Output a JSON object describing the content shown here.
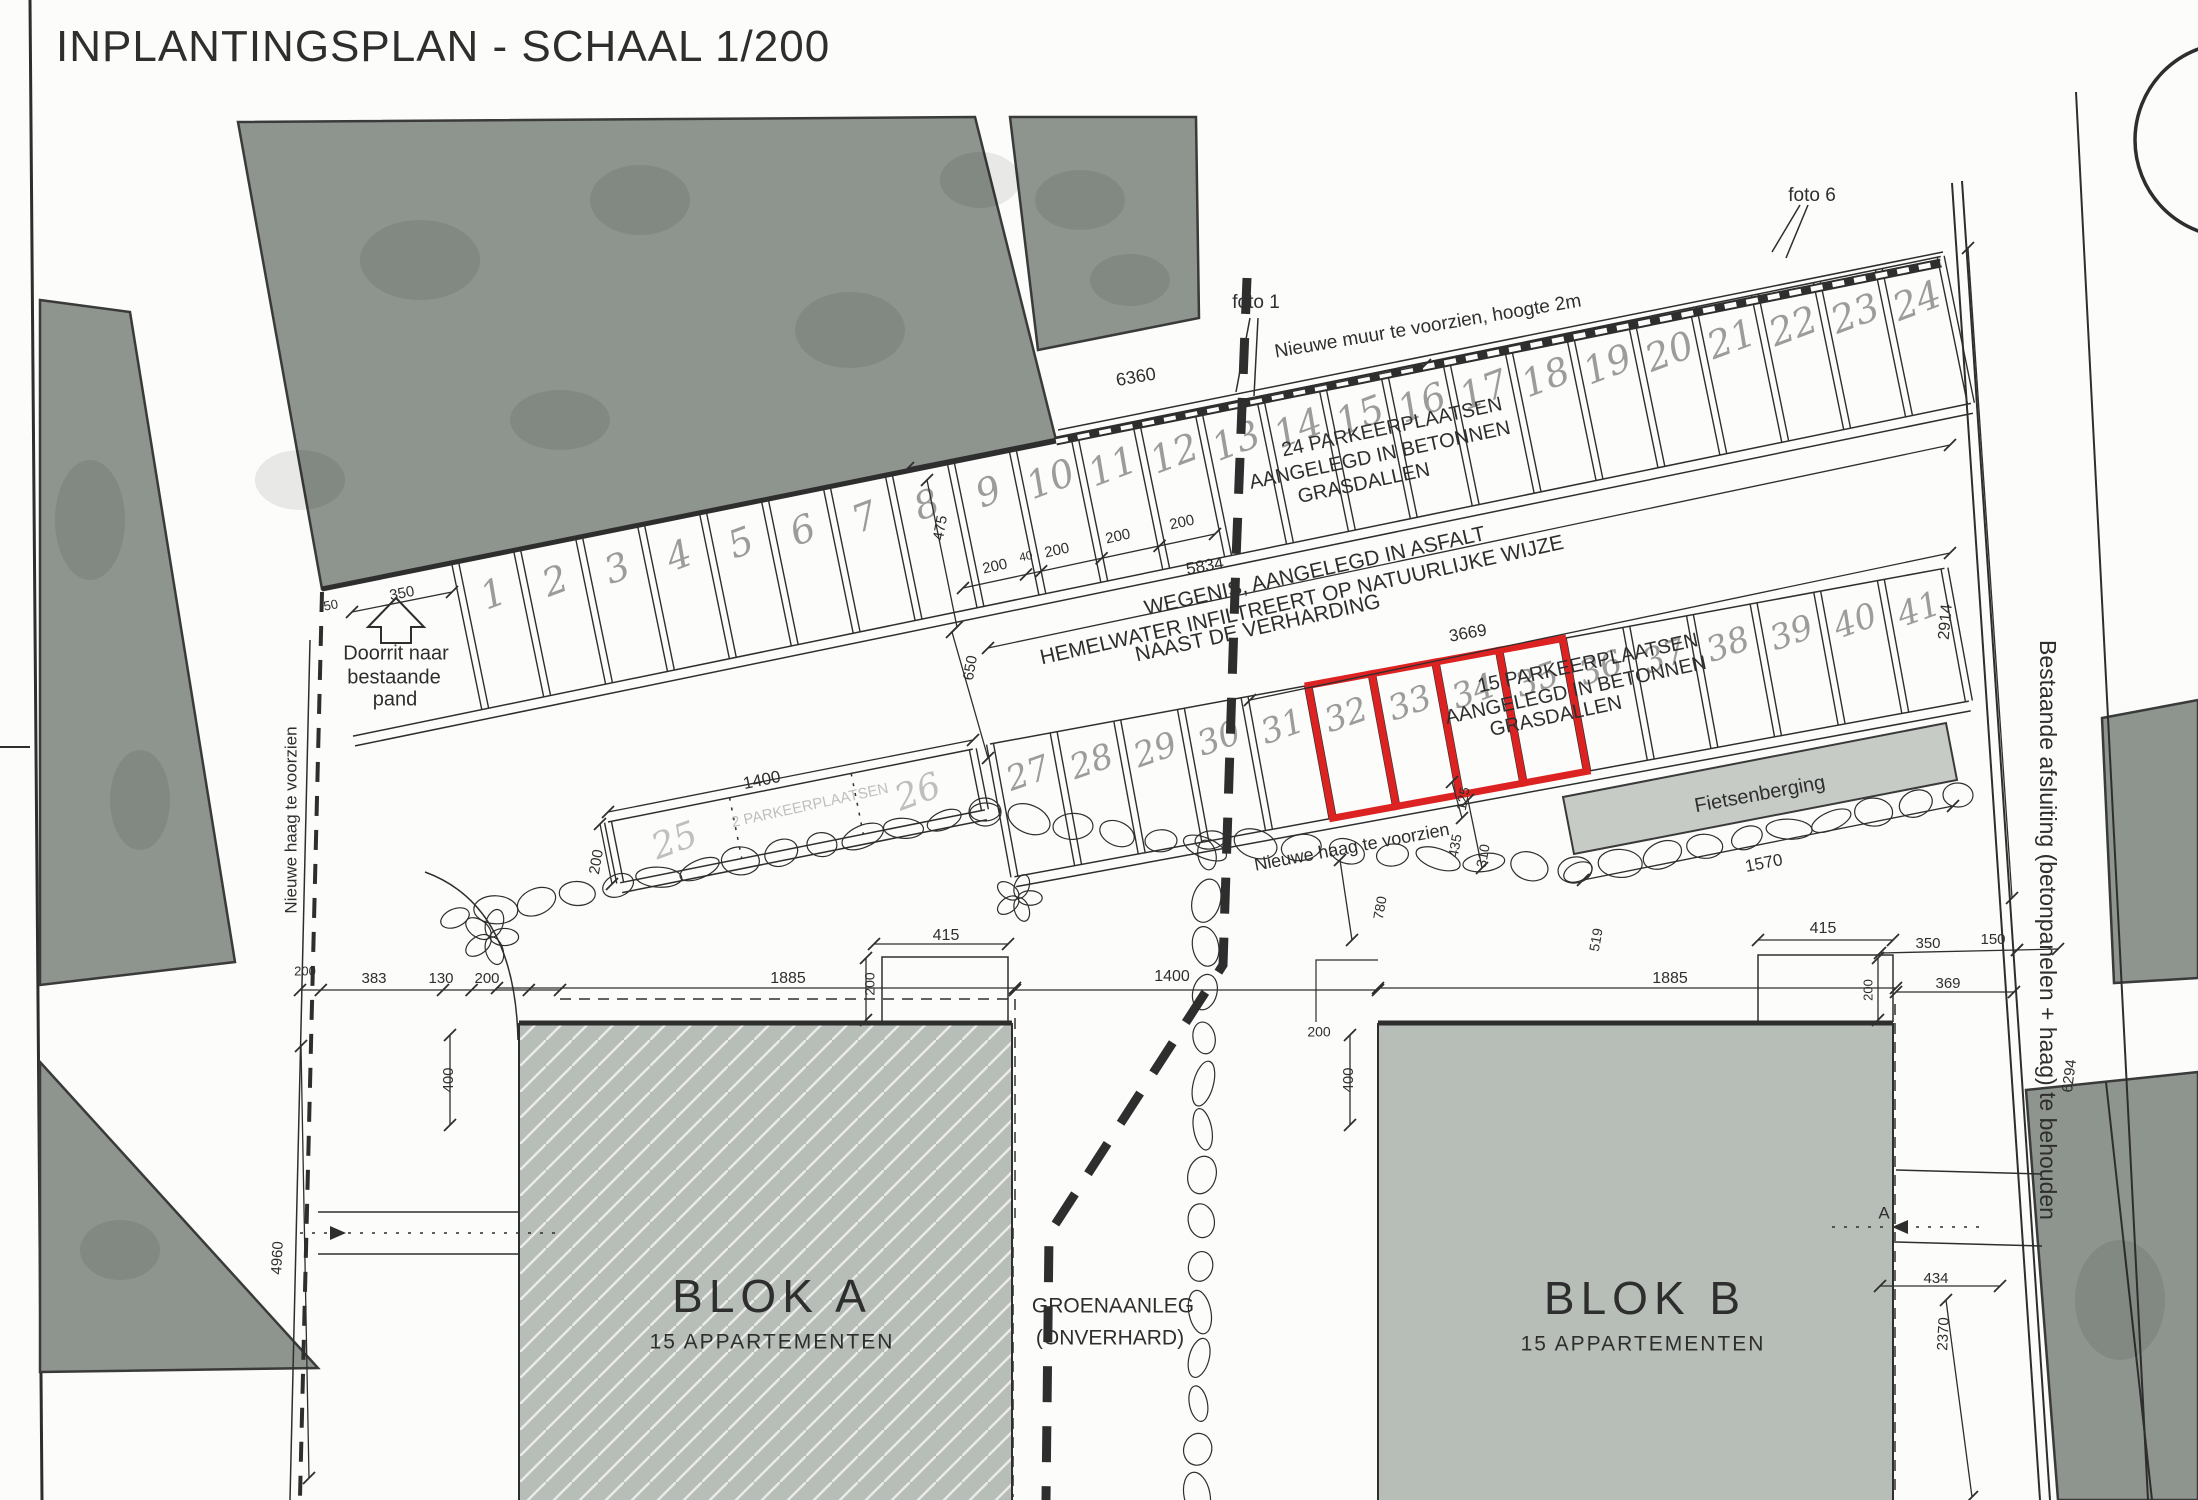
{
  "title": "INPLANTINGSPLAN - SCHAAL 1/200",
  "colors": {
    "ink": "#2e2e2e",
    "building": "#8e948e",
    "building_stroke": "#3a3a3a",
    "block": "#b7bdb7",
    "shed": "#c6cbc6",
    "handwritten": "#9c9c9c",
    "faint": "#bfbfbf",
    "highlight": "#dd2222",
    "paper": "#fcfcfa"
  },
  "parking": {
    "row_top": {
      "note": "24 PARKEERPLAATSEN AANGELEGD IN BETONNEN GRASDALLEN",
      "numbers": [
        "1",
        "2",
        "3",
        "4",
        "5",
        "6",
        "7",
        "8",
        "9",
        "10",
        "11",
        "12",
        "13",
        "14",
        "15",
        "16",
        "17",
        "18",
        "19",
        "20",
        "21",
        "22",
        "23",
        "24"
      ]
    },
    "row_middle": {
      "note": "15 PARKEERPLAATSEN AANGELEGD IN BETONNEN GRASDALLEN",
      "numbers": [
        "27",
        "28",
        "29",
        "30",
        "31",
        "32",
        "33",
        "34",
        "35",
        "36",
        "37",
        "38",
        "39",
        "40",
        "41"
      ],
      "highlighted": [
        "32",
        "33",
        "34",
        "35"
      ]
    },
    "row_small": {
      "note": "2 PARKEERPLAATSEN",
      "numbers": [
        "25",
        "26"
      ]
    }
  },
  "annotations": [
    {
      "id": "nieuwe-muur",
      "t": "Nieuwe muur te voorzien, hoogte 2m",
      "x": 1428,
      "y": 327,
      "r": -9.5,
      "s": 19
    },
    {
      "id": "foto-1",
      "t": "foto 1",
      "x": 1256,
      "y": 303,
      "r": 0,
      "s": 19
    },
    {
      "id": "foto-6",
      "t": "foto 6",
      "x": 1812,
      "y": 196,
      "r": 0,
      "s": 19
    },
    {
      "id": "pp24-line1",
      "t": "24 PARKEERPLAATSEN",
      "x": 1392,
      "y": 428,
      "r": -12,
      "s": 20
    },
    {
      "id": "pp24-line2",
      "t": "AANGELEGD IN BETONNEN",
      "x": 1380,
      "y": 456,
      "r": -12,
      "s": 20
    },
    {
      "id": "pp24-line3",
      "t": "GRASDALLEN",
      "x": 1364,
      "y": 484,
      "r": -12,
      "s": 20
    },
    {
      "id": "wegenis-line1",
      "t": "WEGENIS, AANGELEGD IN ASFALT",
      "x": 1315,
      "y": 572,
      "r": -12.5,
      "s": 21
    },
    {
      "id": "wegenis-line2",
      "t": "HEMELWATER INFILTREERT OP NATUURLIJKE WIJZE",
      "x": 1302,
      "y": 601,
      "r": -12.5,
      "s": 21
    },
    {
      "id": "wegenis-line3",
      "t": "NAAST DE VERHARDING",
      "x": 1258,
      "y": 629,
      "r": -12.5,
      "s": 21
    },
    {
      "id": "pp15-line1",
      "t": "15 PARKEERPLAATSEN",
      "x": 1588,
      "y": 664,
      "r": -12,
      "s": 20
    },
    {
      "id": "pp15-line2",
      "t": "AANGELEGD IN BETONNEN",
      "x": 1576,
      "y": 691,
      "r": -12,
      "s": 20
    },
    {
      "id": "pp15-line3",
      "t": "GRASDALLEN",
      "x": 1556,
      "y": 717,
      "r": -12,
      "s": 20
    },
    {
      "id": "doorrit-line1",
      "t": "Doorrit naar",
      "x": 396,
      "y": 654,
      "r": 0,
      "s": 20
    },
    {
      "id": "doorrit-line2",
      "t": "bestaande",
      "x": 394,
      "y": 678,
      "r": 0,
      "s": 20
    },
    {
      "id": "doorrit-line3",
      "t": "pand",
      "x": 395,
      "y": 700,
      "r": 0,
      "s": 20
    },
    {
      "id": "groen-line1",
      "t": "GROENAANLEG",
      "x": 1113,
      "y": 1307,
      "r": 0,
      "s": 21
    },
    {
      "id": "groen-line2",
      "t": "(ONVERHARD)",
      "x": 1110,
      "y": 1339,
      "r": 0,
      "s": 21
    },
    {
      "id": "blok-a",
      "t": "BLOK A",
      "x": 772,
      "y": 1300,
      "r": 0,
      "s": 46,
      "ls": 6
    },
    {
      "id": "blok-a-sub",
      "t": "15 APPARTEMENTEN",
      "x": 772,
      "y": 1343,
      "r": 0,
      "s": 21,
      "ls": 2
    },
    {
      "id": "blok-b",
      "t": "BLOK B",
      "x": 1645,
      "y": 1302,
      "r": 0,
      "s": 46,
      "ls": 6
    },
    {
      "id": "blok-b-sub",
      "t": "15 APPARTEMENTEN",
      "x": 1643,
      "y": 1345,
      "r": 0,
      "s": 21,
      "ls": 2
    },
    {
      "id": "fietsenberging",
      "t": "Fietsenberging",
      "x": 1760,
      "y": 795,
      "r": -10.5,
      "s": 20
    },
    {
      "id": "haag-links",
      "t": "Nieuwe haag te voorzien",
      "x": 292,
      "y": 820,
      "r": -90,
      "s": 17
    },
    {
      "id": "afsluiting-rechts",
      "t": "Bestaande afsluiting (betonpanelen + haag) te behouden",
      "x": 2046,
      "y": 930,
      "r": 90,
      "s": 23
    },
    {
      "id": "haag-midden",
      "t": "Nieuwe haag te voorzien",
      "x": 1352,
      "y": 848,
      "r": -10.5,
      "s": 18
    },
    {
      "id": "pp2-note",
      "t": "2 PARKEERPLAATSEN",
      "x": 810,
      "y": 806,
      "r": -12.5,
      "s": 15,
      "c": "faint"
    },
    {
      "id": "dim-6360",
      "t": "6360",
      "x": 1136,
      "y": 378,
      "r": -10,
      "s": 18
    },
    {
      "id": "dim-5834",
      "t": "5834",
      "x": 1205,
      "y": 567,
      "r": -10,
      "s": 17
    },
    {
      "id": "dim-3669",
      "t": "3669",
      "x": 1468,
      "y": 634,
      "r": -10,
      "s": 17
    },
    {
      "id": "dim-350-doorrit",
      "t": "350",
      "x": 402,
      "y": 594,
      "r": -11,
      "s": 15
    },
    {
      "id": "dim-50",
      "t": "50",
      "x": 331,
      "y": 606,
      "r": -11,
      "s": 13
    },
    {
      "id": "dim-475",
      "t": "475",
      "x": 941,
      "y": 528,
      "r": -80,
      "s": 15
    },
    {
      "id": "dim-650",
      "t": "650",
      "x": 971,
      "y": 668,
      "r": -80,
      "s": 15
    },
    {
      "id": "dim-200-a",
      "t": "200",
      "x": 995,
      "y": 567,
      "r": -12,
      "s": 15
    },
    {
      "id": "dim-40",
      "t": "40",
      "x": 1026,
      "y": 557,
      "r": -12,
      "s": 12
    },
    {
      "id": "dim-200-b",
      "t": "200",
      "x": 1057,
      "y": 551,
      "r": -12,
      "s": 15
    },
    {
      "id": "dim-200-c",
      "t": "200",
      "x": 1118,
      "y": 537,
      "r": -12,
      "s": 15
    },
    {
      "id": "dim-200-d",
      "t": "200",
      "x": 1182,
      "y": 523,
      "r": -12,
      "s": 15
    },
    {
      "id": "dim-1400-haag",
      "t": "1400",
      "x": 762,
      "y": 781,
      "r": -11.5,
      "s": 17
    },
    {
      "id": "dim-200-haag",
      "t": "200",
      "x": 597,
      "y": 862,
      "r": -80,
      "s": 15
    },
    {
      "id": "dim-125",
      "t": "125",
      "x": 1464,
      "y": 799,
      "r": -80,
      "s": 14
    },
    {
      "id": "dim-435",
      "t": "435",
      "x": 1456,
      "y": 846,
      "r": -80,
      "s": 14
    },
    {
      "id": "dim-310",
      "t": "310",
      "x": 1484,
      "y": 856,
      "r": -80,
      "s": 14
    },
    {
      "id": "dim-780",
      "t": "780",
      "x": 1381,
      "y": 908,
      "r": -80,
      "s": 14
    },
    {
      "id": "dim-519",
      "t": "519",
      "x": 1597,
      "y": 940,
      "r": -80,
      "s": 14
    },
    {
      "id": "dim-1570",
      "t": "1570",
      "x": 1764,
      "y": 864,
      "r": -11,
      "s": 17
    },
    {
      "id": "dim-2914",
      "t": "2914",
      "x": 1946,
      "y": 622,
      "r": -85,
      "s": 16
    },
    {
      "id": "dim-415-a",
      "t": "415",
      "x": 946,
      "y": 936,
      "r": 0,
      "s": 16
    },
    {
      "id": "dim-200-415a",
      "t": "200",
      "x": 871,
      "y": 984,
      "r": -90,
      "s": 14
    },
    {
      "id": "dim-1885-a",
      "t": "1885",
      "x": 788,
      "y": 979,
      "r": 0,
      "s": 16
    },
    {
      "id": "dim-1400-mid",
      "t": "1400",
      "x": 1172,
      "y": 977,
      "r": 0,
      "s": 16
    },
    {
      "id": "dim-1885-b",
      "t": "1885",
      "x": 1670,
      "y": 979,
      "r": 0,
      "s": 16
    },
    {
      "id": "dim-415-b",
      "t": "415",
      "x": 1823,
      "y": 929,
      "r": 0,
      "s": 16
    },
    {
      "id": "dim-350-r",
      "t": "350",
      "x": 1928,
      "y": 944,
      "r": 0,
      "s": 15
    },
    {
      "id": "dim-150-r",
      "t": "150",
      "x": 1993,
      "y": 940,
      "r": 0,
      "s": 15
    },
    {
      "id": "dim-369-r",
      "t": "369",
      "x": 1948,
      "y": 984,
      "r": 0,
      "s": 15
    },
    {
      "id": "dim-434-r",
      "t": "434",
      "x": 1936,
      "y": 1279,
      "r": 0,
      "s": 15
    },
    {
      "id": "dim-2370",
      "t": "2370",
      "x": 1944,
      "y": 1334,
      "r": -87,
      "s": 15
    },
    {
      "id": "dim-6294",
      "t": "6294",
      "x": 2070,
      "y": 1076,
      "r": -83,
      "s": 15
    },
    {
      "id": "dim-200-l",
      "t": "200",
      "x": 305,
      "y": 972,
      "r": 0,
      "s": 13
    },
    {
      "id": "dim-383",
      "t": "383",
      "x": 374,
      "y": 979,
      "r": 0,
      "s": 15
    },
    {
      "id": "dim-130",
      "t": "130",
      "x": 441,
      "y": 979,
      "r": 0,
      "s": 15
    },
    {
      "id": "dim-200-l2",
      "t": "200",
      "x": 487,
      "y": 979,
      "r": 0,
      "s": 15
    },
    {
      "id": "dim-4960",
      "t": "4960",
      "x": 278,
      "y": 1258,
      "r": -87,
      "s": 15
    },
    {
      "id": "dim-400-a",
      "t": "400",
      "x": 449,
      "y": 1080,
      "r": -90,
      "s": 15
    },
    {
      "id": "dim-400-b",
      "t": "400",
      "x": 1349,
      "y": 1080,
      "r": -90,
      "s": 15
    },
    {
      "id": "dim-200-b-left",
      "t": "200",
      "x": 1319,
      "y": 1033,
      "r": 0,
      "s": 14
    },
    {
      "id": "dim-200-b-bump",
      "t": "200",
      "x": 1869,
      "y": 990,
      "r": -90,
      "s": 13
    },
    {
      "id": "section-a",
      "t": "A",
      "x": 1884,
      "y": 1214,
      "r": 0,
      "s": 17
    }
  ]
}
